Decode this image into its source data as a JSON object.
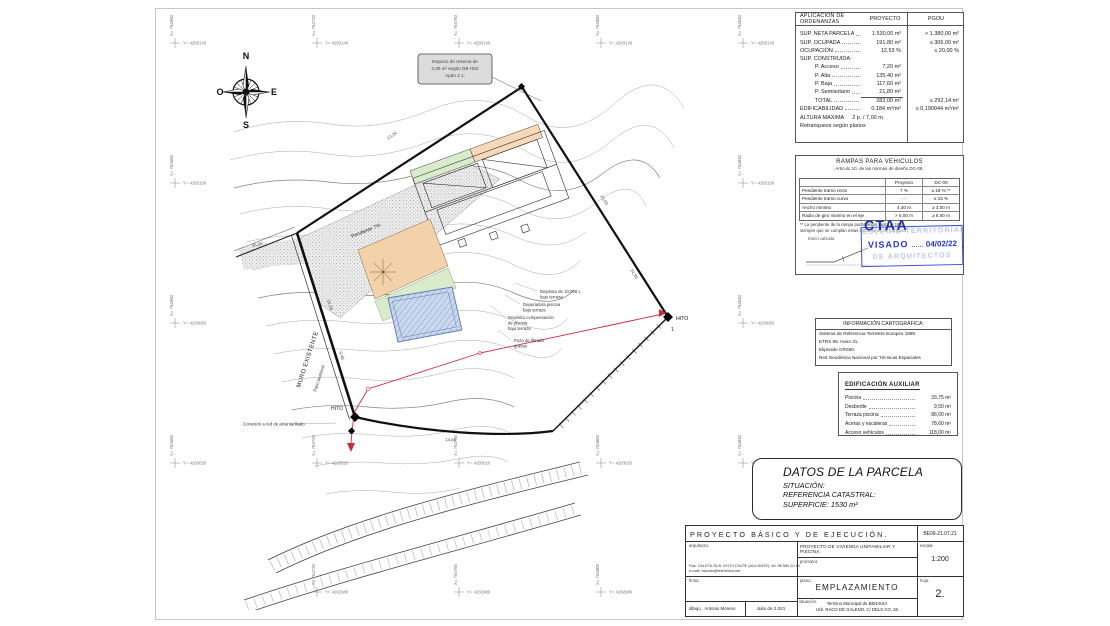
{
  "colors": {
    "stamp_blue": "#3a52d6",
    "stamp_text_blue": "#2336c4",
    "pool_fill": "#c9d8ee",
    "pool_edge": "#5d7ab0",
    "terrace_orange": "#f3d2a9",
    "lawn_green": "#d8ebca",
    "utility_red": "#cb2b3c",
    "contour_gray": "#a8a8a8"
  },
  "compass": {
    "n": "N",
    "s": "S",
    "e": "E",
    "o": "O"
  },
  "grid": {
    "x_labels": [
      "X= 764680",
      "X= 764720",
      "X= 764760",
      "X= 764800",
      "X= 764840"
    ],
    "y_labels": [
      "Y= 4283140",
      "Y= 4283100",
      "Y= 4283060",
      "Y= 4283020",
      "Y= 4282980"
    ]
  },
  "reserva_note": {
    "line1": "Espacio de reserva de",
    "line2": "3,30 m² según DB HS2",
    "line3": "Apdo 2.1."
  },
  "plan": {
    "muro": "MURO EXISTENTE",
    "paso": "Paso peatonal",
    "pendiente": "Pendiente 7%",
    "hito_a": "HITO",
    "hito_a_num": "1",
    "hito_b": "HITO",
    "conexion": "Conexión a red de alcantarillado",
    "deposito_l1": "Depósito de 10.000 L",
    "deposito_l2": "bajo terraza",
    "depuradora_l1": "Depuradora piscina",
    "depuradora_l2": "bajo terraza",
    "compens_l1": "Depósito compensación",
    "compens_l2": "de piscina",
    "compens_l3": "bajo terraza",
    "pozo_l1": "Pozo de filtrado",
    "pozo_l2": "gravas",
    "dims": {
      "d1": "13,29",
      "d2": "16,93",
      "d3": "24,80",
      "d4": "14,84",
      "d5": "16,36",
      "d6": "9,48",
      "d7": "36,99"
    }
  },
  "ordenanzas": {
    "title": "APLICACION DE ORDENANZAS",
    "col2": "PROYECTO",
    "col3": "PGOU",
    "rows": [
      {
        "label": "SUP. NETA PARCELA",
        "p": "1.530,00 m²",
        "g": "> 1.380,00 m²"
      },
      {
        "label": "SUP. OCUPADA",
        "p": "191,80 m²",
        "g": "≤ 306,00 m²"
      },
      {
        "label": "OCUPACIÓN",
        "p": "12,53 %",
        "g": "≤ 20,00 %"
      },
      {
        "label": "SUP. CONSTRUIDA:",
        "p": "",
        "g": ""
      },
      {
        "label": "P. Acceso",
        "p": "7,20 m²",
        "g": ""
      },
      {
        "label": "P. Alta",
        "p": "135,40 m²",
        "g": ""
      },
      {
        "label": "P. Baja",
        "p": "117,60 m²",
        "g": ""
      },
      {
        "label": "P. Semisotano",
        "p": "21,80 m²",
        "g": ""
      },
      {
        "label": "TOTAL",
        "p": "282,00 m²",
        "g": "≤ 292,14 m²"
      },
      {
        "label": "EDIFICABILIDAD",
        "p": "0,184 m²/m²",
        "g": "≤ 0,190944 m²/m²"
      }
    ],
    "altura_label": "ALTURA MAXIMA",
    "altura_value": "2 p. / 7,00 m.",
    "retranqueos": "Retranqueos según planos"
  },
  "rampas": {
    "title": "RAMPAS PARA VEHICULOS",
    "subtitle": "Articulo 10. de  las normas de diseño  DC-09.",
    "col2": "Proyecto",
    "col3": "DC-09",
    "rows": [
      {
        "label": "Pendiente tramo recto",
        "p": "7 %",
        "g": "≤ 18 % **"
      },
      {
        "label": "Pendiente tramo curvo",
        "p": "- -",
        "g": "≤ 15 %"
      },
      {
        "label": "Ancho minimo",
        "p": "4,40 m",
        "g": "≥ 3,00 m"
      },
      {
        "label": "Radio de giro minimo en el eje",
        "p": "> 6,00 m",
        "g": "≥ 6,00 m"
      }
    ],
    "note1": "** La pendiente de la rampa podra llegar hasta el 18 %",
    "note2": "siempre que se cumplan estas condiciones de transición",
    "diagram_label": "tramo  calzada"
  },
  "stamp": {
    "org": "CTAA",
    "wm1": "COLEGIO TERRITORIAL",
    "wm2": "DE ARQUITECTOS",
    "visado": "VISADO",
    "date": "04/02/22"
  },
  "cartografia": {
    "title": "INFORMACIÓN CARTOGRÁFICA:",
    "line1": "Sistema de Referencia Terrestre Europeo 1989.",
    "line2": "ETRS 89. Huso 31.",
    "line3": "Elipsoide GRS80.",
    "line4": "Red Geodésica Nacional por Técnicas Espaciales"
  },
  "aux": {
    "title": "EDIFICACIÓN AUXILIAR",
    "rows": [
      {
        "label": "Piscina",
        "v": "33,75 m²"
      },
      {
        "label": "Desborde",
        "v": "9,50 m²"
      },
      {
        "label": "Terraza piscina",
        "v": "86,00 m²"
      },
      {
        "label": "Aceras y escaleras",
        "v": "78,60 m²"
      },
      {
        "label": "Acceso vehículos",
        "v": "118,00 m²"
      }
    ]
  },
  "parcela": {
    "title": "DATOS DE LA PARCELA",
    "line1": "SITUACIÓN:",
    "line2": "REFERENCIA CATASTRAL:",
    "line3": "SUPERFICIE: 1530 m²"
  },
  "titleblock": {
    "header": "PROYECTO  BÁSICO  Y  DE  EJECUCIÓN.",
    "ref": "BE09-21.07.21",
    "arquitecto_label": "arquitecto.",
    "arquitecto_line1": "Pas. CALETA 25-B, 03710 CALPE (ALICANTE). tel: 96 583 20 44.",
    "arquitecto_line2": "e-mail: estudio@telefonica.net",
    "proyecto_text": "PROYECTO  DE  VIVIENDA  UNIFAMILIAR  Y  PISCINA.",
    "promotor_label": "promotor.",
    "escala_label": "escala.",
    "escala_value": "1:200",
    "firma_label": "firma.",
    "plano_label": "plano.",
    "plano_value": "EMPLAZAMIENTO",
    "hoja_label": "hoja.",
    "hoja_value": "2.",
    "situacion_label": "situación.",
    "situacion_line1": "Termino Municipal de BENISSA",
    "situacion_line2": "Urb. RACO DE GALENO, C/ DELS CO, 26",
    "dibujo_label": "dibujo.",
    "dibujo_value": "Antonio Moreno",
    "fecha": "Julio de 2.021"
  }
}
